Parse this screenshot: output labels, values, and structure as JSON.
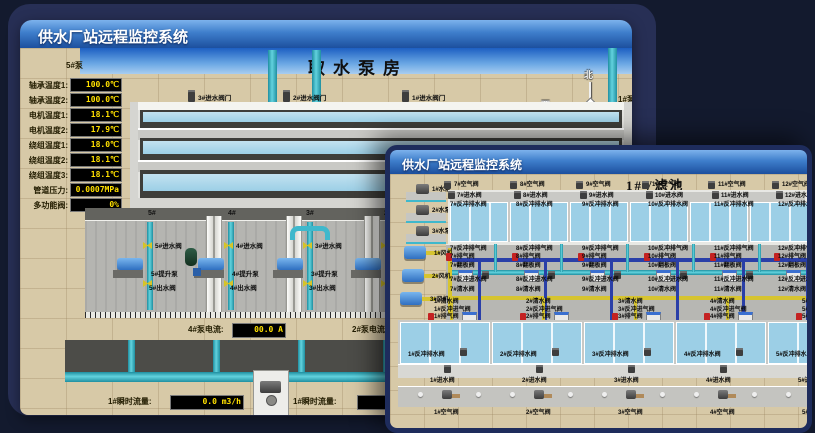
{
  "colors": {
    "titlebar_blue": "#3e7ecb",
    "value_yellow": "#ffe000",
    "pipe_cyan": "#3fb8cc",
    "valve_yellow": "#d6c428",
    "alarm_red": "#c42222",
    "pool_water": "#aed6e8",
    "floor_tan": "#d7c9a7",
    "window_border_navy": "#1e2c5c"
  },
  "back_window": {
    "title": "供水厂站远程监控系统",
    "scene_title": "取水泵房",
    "compass": {
      "north": "北",
      "south": "南",
      "east": "东",
      "west": "西"
    },
    "pump_panel": {
      "header": "5#泵",
      "rows": [
        {
          "label": "轴承温度1:",
          "value": "100.0℃"
        },
        {
          "label": "轴承温度2:",
          "value": "100.0℃"
        },
        {
          "label": "电机温度1:",
          "value": "18.1℃"
        },
        {
          "label": "电机温度2:",
          "value": "17.9℃"
        },
        {
          "label": "绕组温度1:",
          "value": "18.0℃"
        },
        {
          "label": "绕组温度2:",
          "value": "18.1℃"
        },
        {
          "label": "绕组温度3:",
          "value": "18.1℃"
        },
        {
          "label": "管道压力:",
          "value": "0.0007MPa"
        },
        {
          "label": "多功能阀:",
          "value": "0%"
        }
      ]
    },
    "right_panel": {
      "header": "1#泵",
      "rows": [
        "轴承温度1:",
        "轴承温度2:"
      ]
    },
    "inlet_valves": [
      "3#进水阀门",
      "2#进水阀门",
      "1#进水阀门"
    ],
    "pump_bays": [
      {
        "bay": "5#",
        "valve_in": "5#进水阀",
        "pump": "5#提升泵",
        "valve_out": "5#出水阀"
      },
      {
        "bay": "4#",
        "valve_in": "4#进水阀",
        "pump": "4#提升泵",
        "valve_out": "4#出水阀"
      },
      {
        "bay": "3#",
        "valve_in": "3#进水阀",
        "pump": "3#提升泵",
        "valve_out": "3#出水阀"
      },
      {
        "bay": "2#",
        "valve_in": "2#进水阀",
        "pump": "2#提升泵",
        "valve_out": "2#出水阀"
      }
    ],
    "current": [
      {
        "label": "4#泵电流:",
        "value": "00.0 A"
      },
      {
        "label": "2#泵电流:",
        "value": "00.0 A"
      }
    ],
    "flow": [
      {
        "label": "1#瞬时流量:",
        "value": "0.0 m3/h"
      },
      {
        "label": "1#瞬时流量:",
        "value": "0.0 m3/h"
      }
    ]
  },
  "front_window": {
    "title": "供水厂站远程监控系统",
    "scene_title": "1#V滤池",
    "pumps": [
      "1#水泵",
      "2#水泵",
      "3#水泵"
    ],
    "blowers": [
      "1#风机",
      "2#风机",
      "3#风机"
    ],
    "top_pools": [
      {
        "air": "7#空气阀",
        "inlet": "7#进水阀",
        "drain": "7#反冲排水阀"
      },
      {
        "air": "8#空气阀",
        "inlet": "8#进水阀",
        "drain": "8#反冲排水阀"
      },
      {
        "air": "9#空气阀",
        "inlet": "9#进水阀",
        "drain": "9#反冲排水阀"
      },
      {
        "air": "10#空气阀",
        "inlet": "10#进水阀",
        "drain": "10#反冲排水阀"
      },
      {
        "air": "11#空气阀",
        "inlet": "11#进水阀",
        "drain": "11#反冲排水阀"
      },
      {
        "air": "12#空气阀",
        "inlet": "12#进水阀",
        "drain": "12#反冲排水阀"
      }
    ],
    "walkway_top_rows": [
      {
        "kind": "plain",
        "labels": [
          "7#反冲排气阀",
          "8#反冲排气阀",
          "9#反冲排气阀",
          "10#反冲排气阀",
          "11#反冲排气阀",
          "12#反冲排气阀"
        ]
      },
      {
        "kind": "red",
        "labels": [
          "7#排气阀",
          "8#排气阀",
          "9#排气阀",
          "10#排气阀",
          "11#排气阀",
          "12#排气阀"
        ]
      },
      {
        "kind": "tank",
        "labels": [
          "7#翻板阀",
          "8#翻板阀",
          "9#翻板阀",
          "10#翻板阀",
          "11#翻板阀",
          "12#翻板阀"
        ]
      },
      {
        "kind": "cyan",
        "labels": [
          "7#反冲进水阀",
          "8#反冲进水阀",
          "9#反冲进水阀",
          "10#反冲进水阀",
          "11#反冲进水阀",
          "12#反冲进水阀"
        ]
      },
      {
        "kind": "plain",
        "labels": [
          "7#清水阀",
          "8#清水阀",
          "9#清水阀",
          "10#清水阀",
          "11#清水阀",
          "12#清水阀"
        ]
      }
    ],
    "walkway_bottom_rows": [
      {
        "kind": "plain",
        "labels": [
          "1#清水阀",
          "2#清水阀",
          "3#清水阀",
          "4#清水阀",
          "5#清水阀",
          "6#清水阀"
        ]
      },
      {
        "kind": "plain",
        "labels": [
          "1#反冲进气阀",
          "2#反冲进气阀",
          "3#反冲进气阀",
          "4#反冲进气阀",
          "5#反冲进气阀",
          "6#反冲进气阀"
        ]
      },
      {
        "kind": "red",
        "labels": [
          "1#排气阀",
          "2#排气阀",
          "3#排气阀",
          "4#排气阀",
          "5#排气阀",
          "6#排气阀"
        ]
      }
    ],
    "bottom_pools": [
      {
        "drain": "1#反冲排水阀",
        "inlet": "1#进水阀",
        "air": "1#空气阀"
      },
      {
        "drain": "2#反冲排水阀",
        "inlet": "2#进水阀",
        "air": "2#空气阀"
      },
      {
        "drain": "3#反冲排水阀",
        "inlet": "3#进水阀",
        "air": "3#空气阀"
      },
      {
        "drain": "4#反冲排水阀",
        "inlet": "4#进水阀",
        "air": "4#空气阀"
      },
      {
        "drain": "5#反冲排水阀",
        "inlet": "5#进水阀",
        "air": "5#空气阀"
      },
      {
        "drain": "6#反冲排水阀",
        "inlet": "6#进水阀",
        "air": "6#空气阀"
      }
    ]
  }
}
